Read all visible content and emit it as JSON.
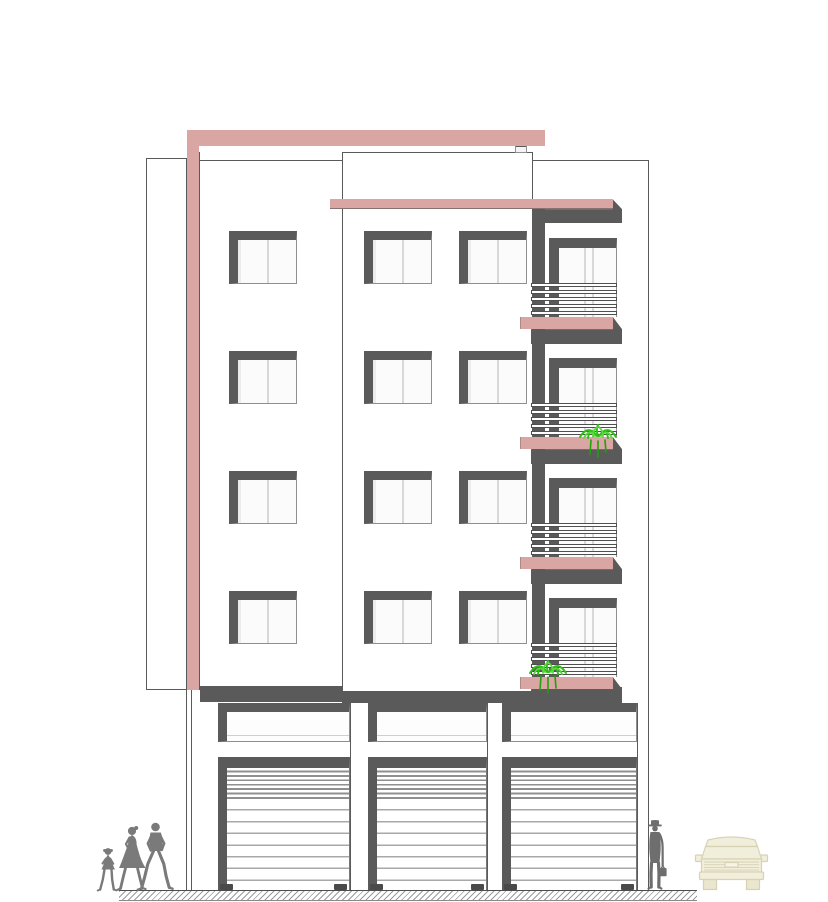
{
  "drawing": {
    "kind": "building-front-elevation"
  },
  "palette": {
    "paper": "#ffffff",
    "pink": "#d9a6a4",
    "dark": "#5a5a5a",
    "line": "#5a5a5a",
    "pane": "#fbfbfb",
    "pane-tint": "#ececec",
    "divider": "#d8d8d8",
    "slat": "#8f8f8f",
    "slat-light": "#a8a8a8",
    "figure": "#7a7a7a",
    "figure-dark": "#6e6e6e",
    "plant": "#2fbf17",
    "plant-light": "#5bd83e",
    "plant-dark": "#1da30c",
    "car-fill": "#f1eedb",
    "car-line": "#d8d2b4",
    "hatch": "#9b9b9b"
  },
  "elevation": {
    "upper_floors": 4,
    "floor_pitch": 120,
    "first_floor_door_y": 238,
    "window_rows_y": [
      231,
      351,
      471,
      591
    ],
    "window_columns_x": [
      229,
      364,
      459
    ],
    "window_w": 68,
    "window_h": 53,
    "balcony": {
      "door_x": 549,
      "door_w": 68,
      "door_h": 79,
      "rail_x": 531,
      "rail_w": 86,
      "rail_h": 32,
      "rail_bars": 5,
      "rail_offset": 45,
      "slab_x": 520,
      "slab_w": 93,
      "slab_h": 12,
      "shadow_x": 531,
      "shadow_w": 91,
      "shadow_h": 27
    },
    "plants": [
      {
        "x": 576,
        "y": 424
      },
      {
        "x": 526,
        "y": 660
      }
    ],
    "shops": [
      {
        "x": 218,
        "w": 132
      },
      {
        "x": 368,
        "w": 119
      },
      {
        "x": 502,
        "w": 135
      }
    ],
    "transom_y": 703,
    "transom_h": 39,
    "shutter_y": 757,
    "shutter_h": 133,
    "handle_y": 884
  },
  "scene": {
    "figures": [
      "family-walking",
      "man-standing"
    ],
    "vehicle": "car-front-view",
    "ground": "hatched-ground-line"
  }
}
